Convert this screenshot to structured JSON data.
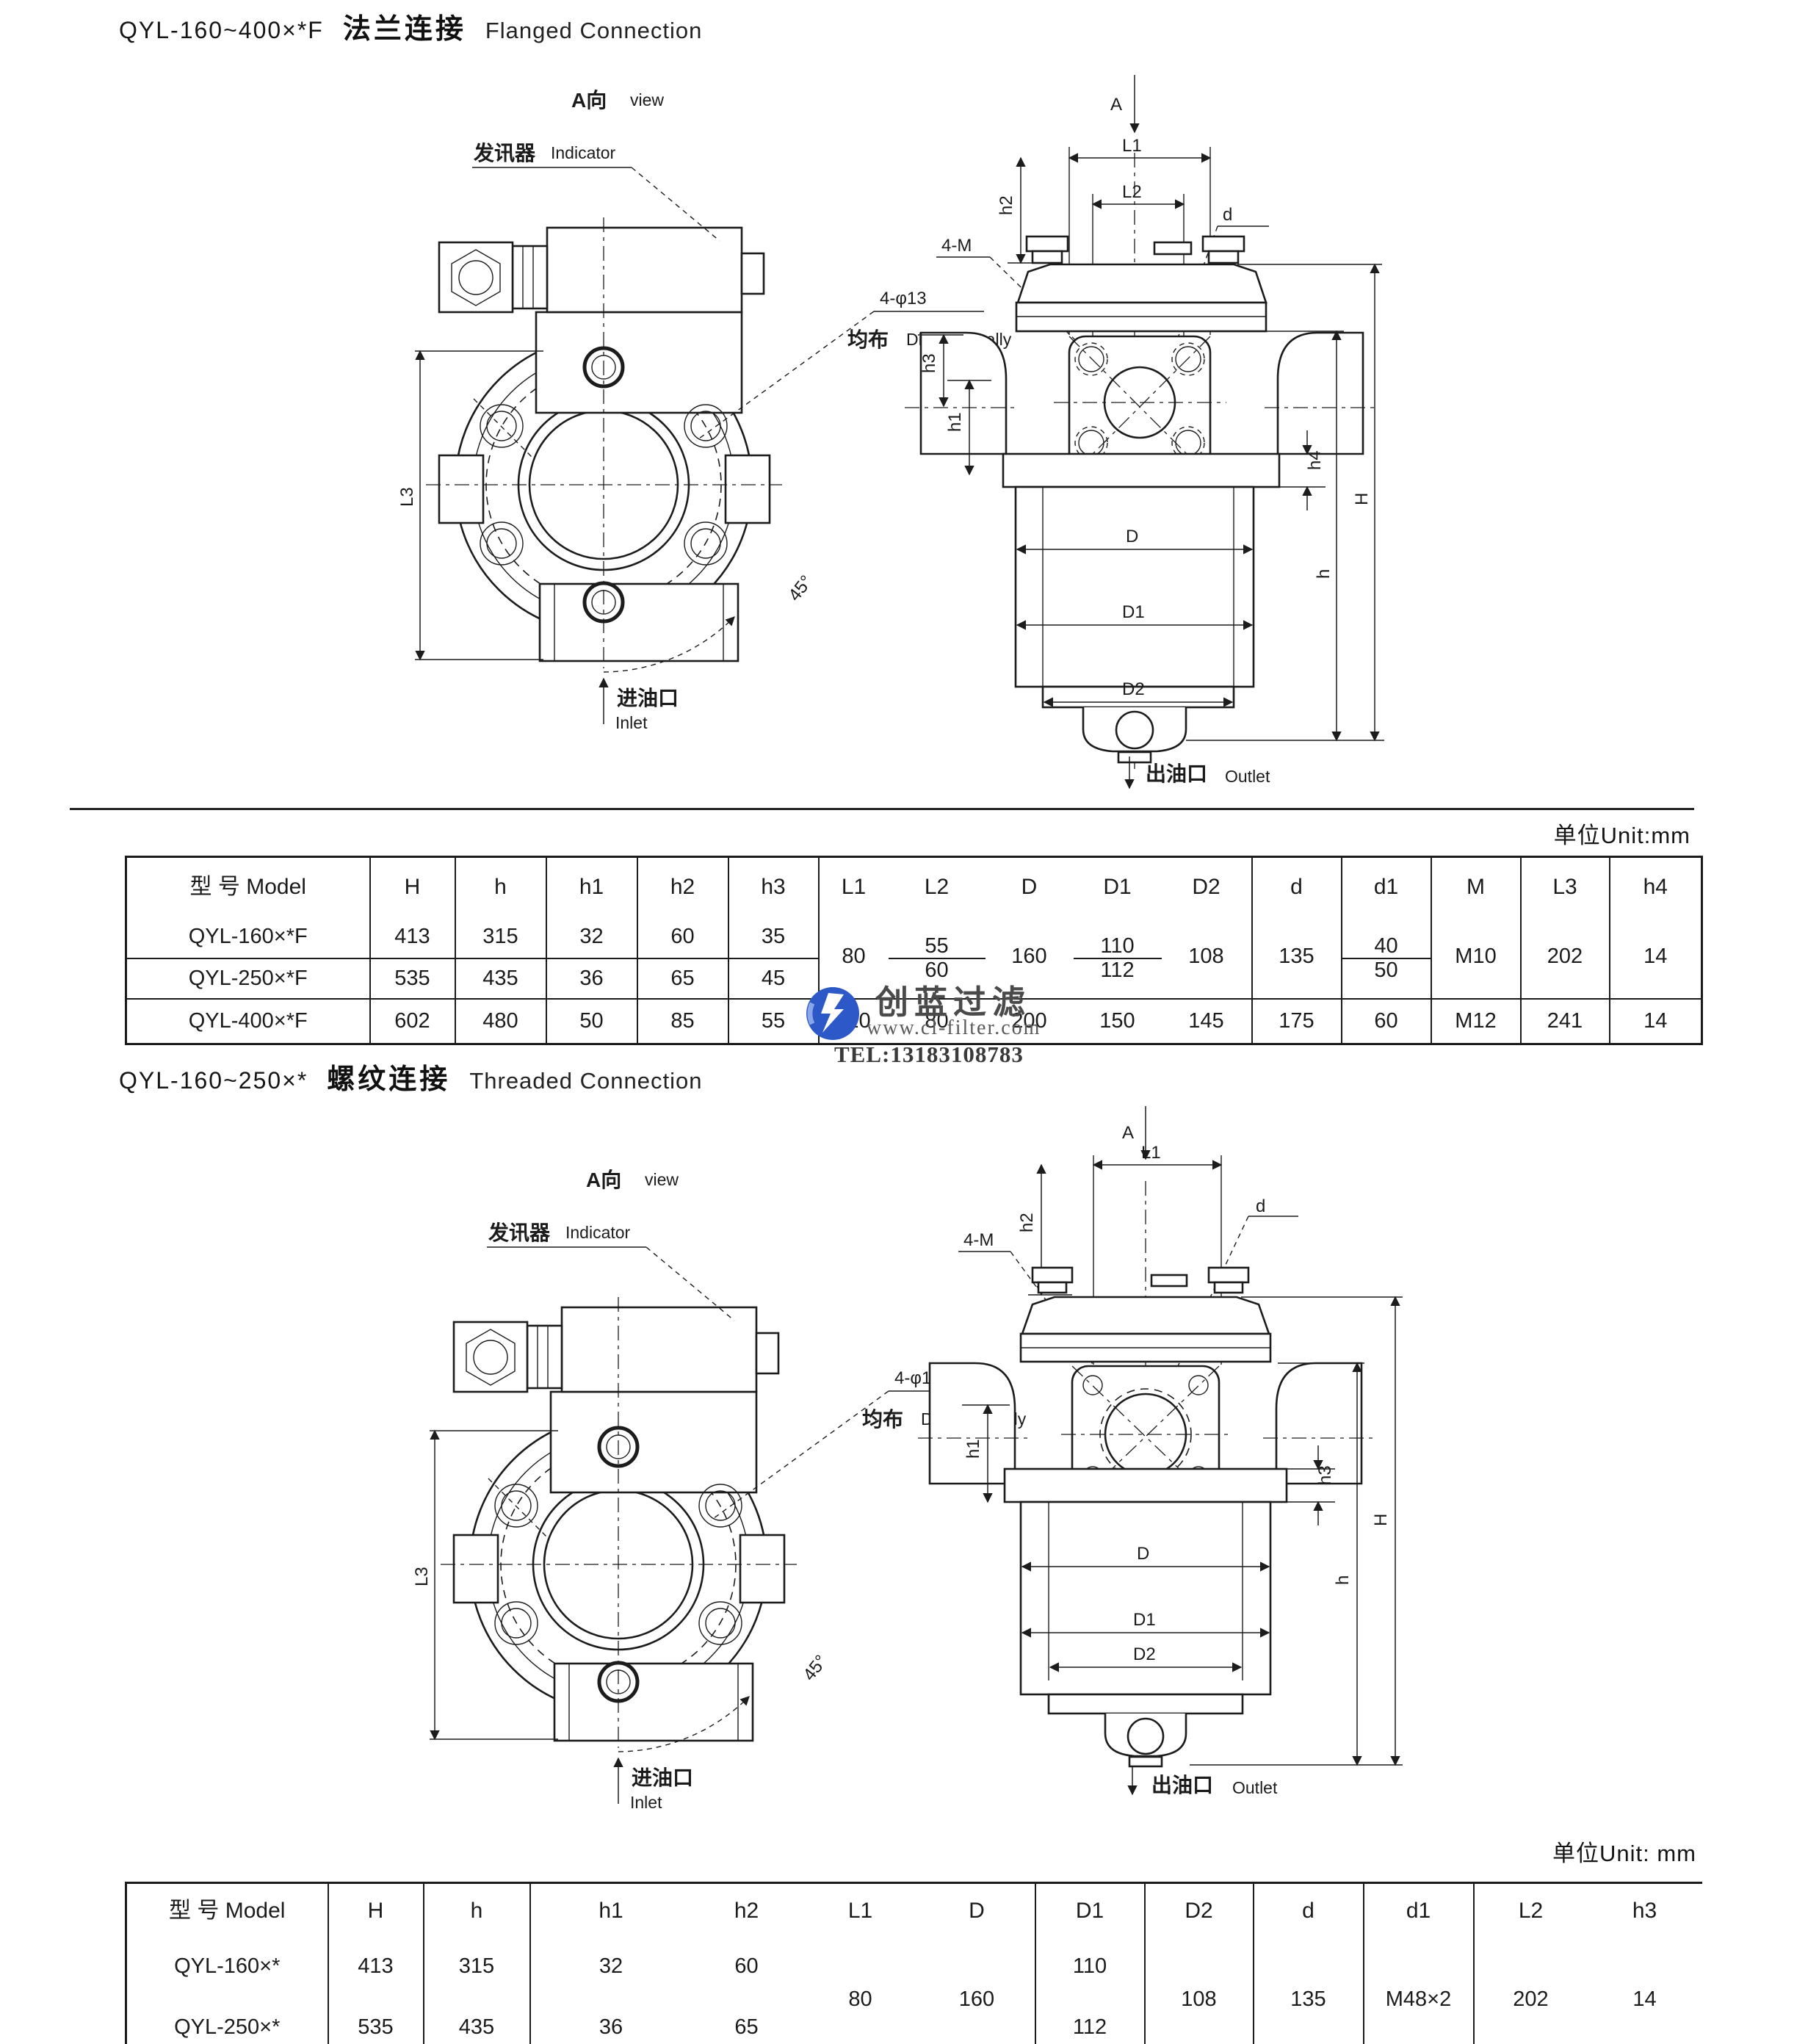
{
  "doc": {
    "bg": "#ffffff",
    "ink": "#1b1b1b"
  },
  "drawing_labels": {
    "view_cn": "A向",
    "view_en": "view",
    "indicator_cn": "发讯器",
    "indicator_en": "Indicator",
    "holes_note": "4-φ13",
    "divide_cn": "均布",
    "divide_en": "Divide equally",
    "inlet_cn": "进油口",
    "inlet_en": "Inlet",
    "outlet_cn": "出油口",
    "outlet_en": "Outlet",
    "angle": "45°",
    "dims": {
      "A": "A",
      "L1": "L1",
      "L2": "L2",
      "L3": "L3",
      "d": "d",
      "bolt": "4-M",
      "h1": "h1",
      "h2": "h2",
      "h3": "h3",
      "h4": "h4",
      "H": "H",
      "h": "h",
      "D": "D",
      "D1": "D1",
      "D2": "D2"
    }
  },
  "section1": {
    "title": {
      "model": "QYL-160~400×*F",
      "cn": "法兰连接",
      "en": "Flanged Connection"
    },
    "unit": "单位Unit:mm",
    "table": {
      "headers": [
        "型 号 Model",
        "H",
        "h",
        "h1",
        "h2",
        "h3",
        "L1",
        "L2",
        "D",
        "D1",
        "D2",
        "d",
        "d1",
        "M",
        "L3",
        "h4"
      ],
      "rows": {
        "r1": {
          "model": "QYL-160×*F",
          "H": "413",
          "h": "315",
          "h1": "32",
          "h2": "60",
          "h3": "35",
          "L2": "55",
          "D1": "110",
          "d1": "40"
        },
        "r2": {
          "model": "QYL-250×*F",
          "H": "535",
          "h": "435",
          "h1": "36",
          "h2": "65",
          "h3": "45",
          "L2": "60",
          "D1": "112",
          "d1": "50"
        },
        "merged": {
          "L1": "80",
          "D": "160",
          "D2": "108",
          "d": "135",
          "M": "M10",
          "L3": "202",
          "h4": "14"
        },
        "r3": {
          "model": "QYL-400×*F",
          "H": "602",
          "h": "480",
          "h1": "50",
          "h2": "85",
          "h3": "55",
          "L1": "110",
          "L2": "80",
          "D": "200",
          "D1": "150",
          "D2": "145",
          "d": "175",
          "d1": "60",
          "M": "M12",
          "L3": "241",
          "h4": "14"
        }
      }
    }
  },
  "section2": {
    "title": {
      "model": "QYL-160~250×*",
      "cn": "螺纹连接",
      "en": "Threaded Connection"
    },
    "unit": "单位Unit: mm",
    "table": {
      "headers": [
        "型 号 Model",
        "H",
        "h",
        "h1",
        "h2",
        "L1",
        "D",
        "D1",
        "D2",
        "d",
        "d1",
        "L2",
        "h3"
      ],
      "rows": {
        "r1": {
          "model": "QYL-160×*",
          "H": "413",
          "h": "315",
          "h1": "32",
          "h2": "60",
          "D1": "110"
        },
        "r2": {
          "model": "QYL-250×*",
          "H": "535",
          "h": "435",
          "h1": "36",
          "h2": "65",
          "D1": "112"
        },
        "merged": {
          "L1": "80",
          "D": "160",
          "D2": "108",
          "d": "135",
          "d1": "M48×2",
          "L2": "202",
          "h3": "14"
        }
      }
    }
  },
  "watermark": {
    "name": "创蓝过滤",
    "site": "www.cl-filter.com",
    "tel": "TEL:13183108783",
    "blue": "#2d58c8"
  }
}
